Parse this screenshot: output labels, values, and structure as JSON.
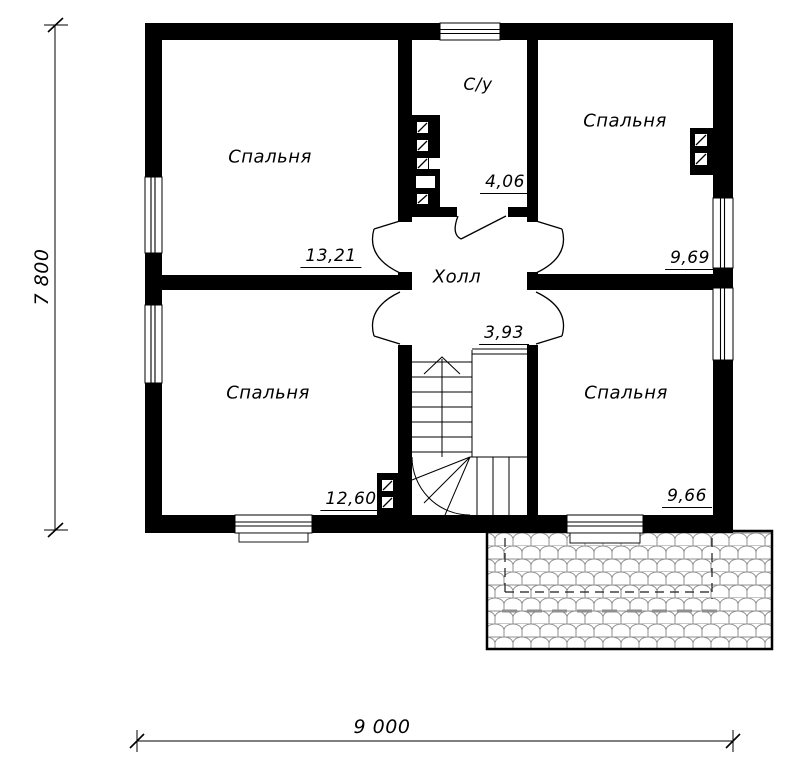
{
  "rooms": {
    "bedroom_tl": {
      "label": "Спальня",
      "area": "13,21"
    },
    "bathroom": {
      "label": "С/у",
      "area": "4,06"
    },
    "bedroom_tr": {
      "label": "Спальня",
      "area": "9,69"
    },
    "hall": {
      "label": "Холл",
      "area": "3,93"
    },
    "bedroom_bl": {
      "label": "Спальня",
      "area": "12,60"
    },
    "bedroom_br": {
      "label": "Спальня",
      "area": "9,66"
    }
  },
  "dimensions": {
    "overall_height_mm": "7 800",
    "overall_width_mm": "9 000"
  },
  "colors": {
    "wall": "#000000",
    "background": "#ffffff",
    "roof_tile_line": "#8f8f8f"
  }
}
